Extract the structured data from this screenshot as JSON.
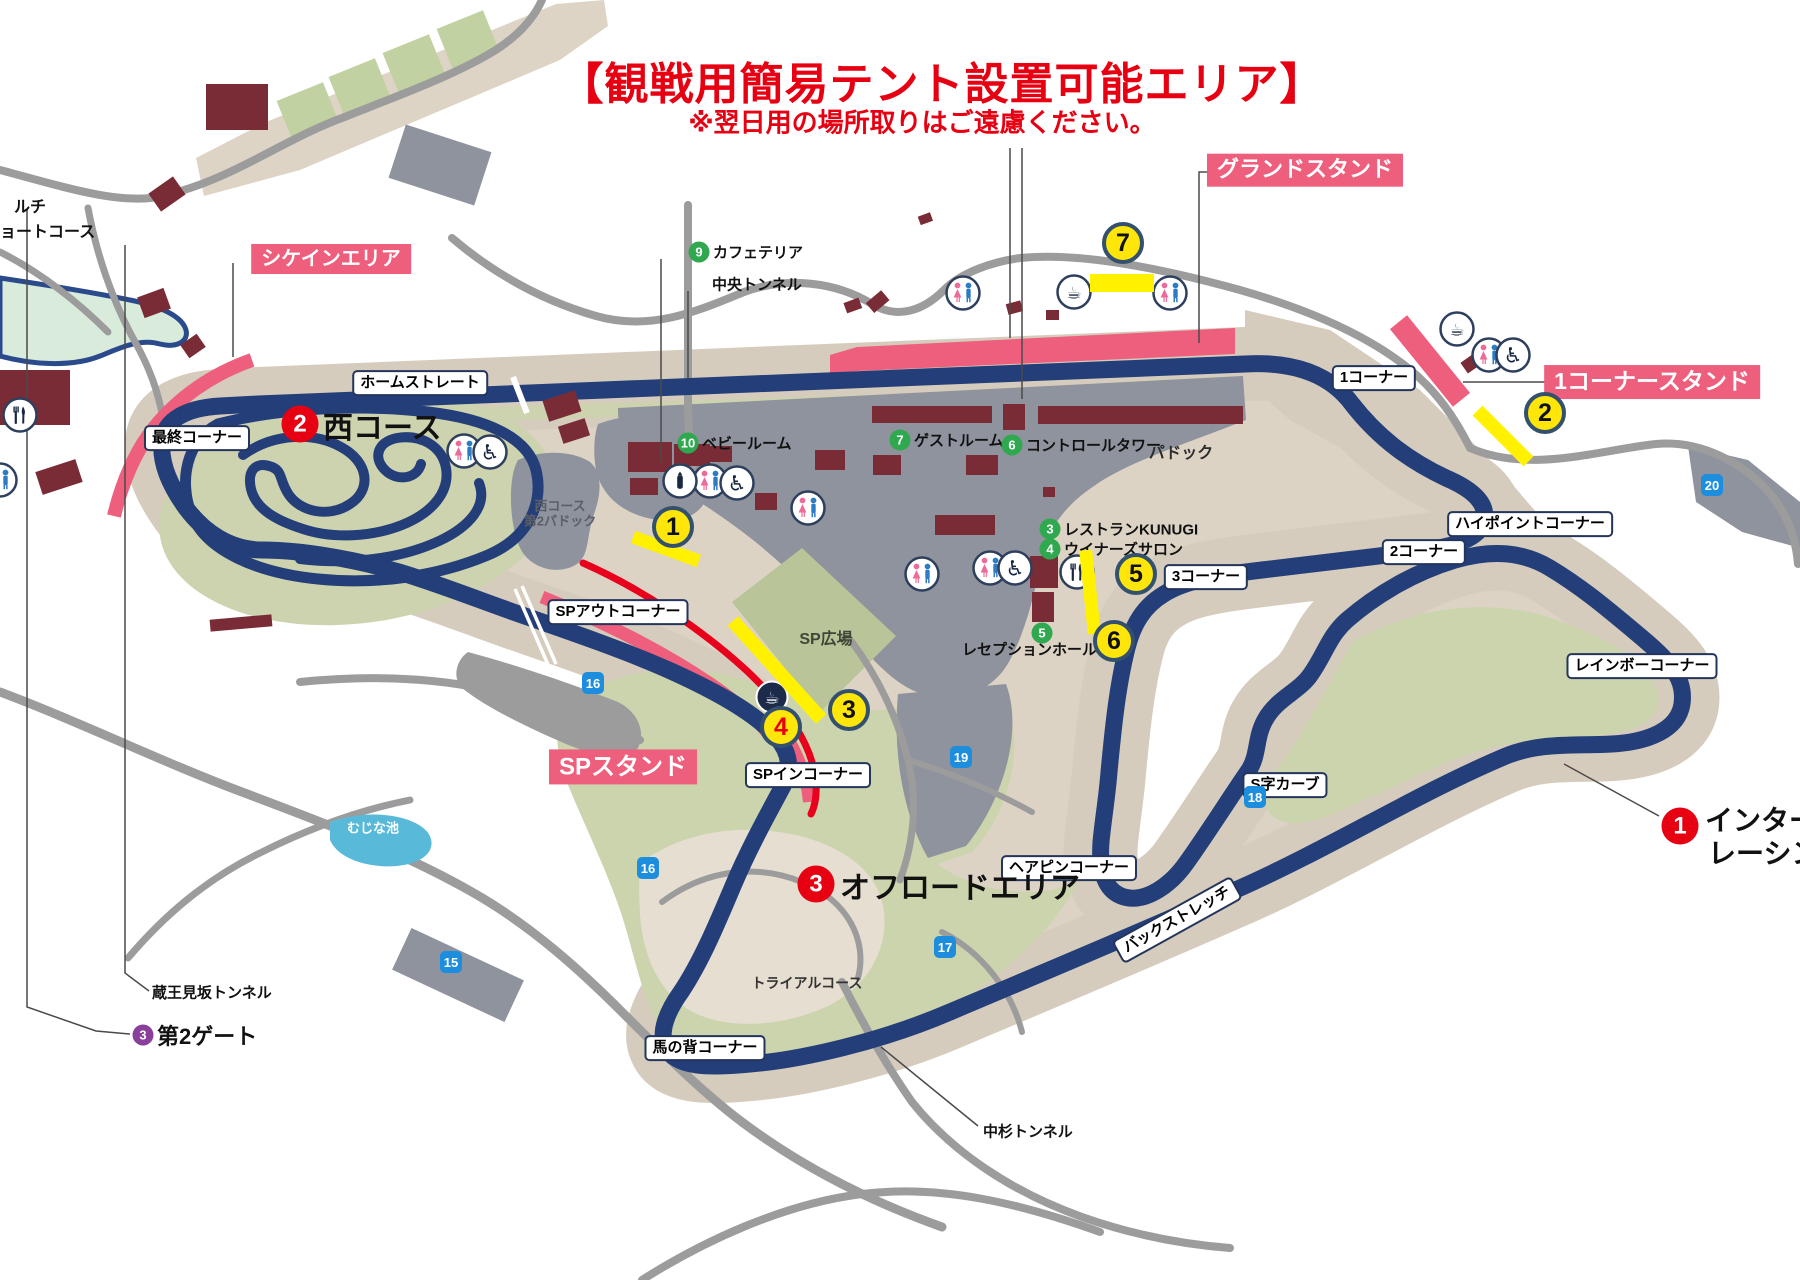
{
  "title": {
    "main": "【観戦用簡易テント設置可能エリア】",
    "note": "※翌日用の場所取りはご遠慮ください。",
    "color": "#e60012"
  },
  "colors": {
    "track_navy": "#233e78",
    "stand_pink": "#ee5f7d",
    "highlight_yellow": "#fff100",
    "highlight_red": "#e8001c",
    "facility_green": "#2fa84f",
    "gate_purple": "#8a3f9b",
    "badge_blue": "#1d8ede",
    "title_red": "#e60012"
  },
  "pink_labels": [
    {
      "t": "シケインエリア",
      "x": 331,
      "y": 259,
      "fs": 20
    },
    {
      "t": "グランドスタンド",
      "x": 1305,
      "y": 170,
      "fs": 22
    },
    {
      "t": "1コーナースタンド",
      "x": 1652,
      "y": 382,
      "fs": 23
    },
    {
      "t": "SPスタンド",
      "x": 623,
      "y": 767,
      "fs": 24
    }
  ],
  "corner_labels": [
    {
      "t": "ホームストレート",
      "x": 420,
      "y": 383
    },
    {
      "t": "最終コーナー",
      "x": 197,
      "y": 438
    },
    {
      "t": "SPアウトコーナー",
      "x": 618,
      "y": 612
    },
    {
      "t": "SPインコーナー",
      "x": 808,
      "y": 775
    },
    {
      "t": "1コーナー",
      "x": 1374,
      "y": 378
    },
    {
      "t": "2コーナー",
      "x": 1424,
      "y": 552
    },
    {
      "t": "3コーナー",
      "x": 1206,
      "y": 577
    },
    {
      "t": "ハイポイントコーナー",
      "x": 1530,
      "y": 524
    },
    {
      "t": "レインボーコーナー",
      "x": 1642,
      "y": 666
    },
    {
      "t": "S字カーブ",
      "x": 1285,
      "y": 785
    },
    {
      "t": "ヘアピンコーナー",
      "x": 1069,
      "y": 868
    },
    {
      "t": "バックストレッチ",
      "x": 1177,
      "y": 920,
      "rot": -29
    },
    {
      "t": "馬の背コーナー",
      "x": 705,
      "y": 1048
    }
  ],
  "text_labels": [
    {
      "t": "中央トンネル",
      "x": 712,
      "y": 284,
      "fs": 15,
      "anchor": "left",
      "color": "#111"
    },
    {
      "t": "蔵王見坂トンネル",
      "x": 152,
      "y": 992,
      "fs": 15,
      "anchor": "left",
      "color": "#111"
    },
    {
      "t": "中杉トンネル",
      "x": 983,
      "y": 1131,
      "fs": 15,
      "anchor": "left",
      "color": "#111"
    },
    {
      "t": "パドック",
      "x": 1181,
      "y": 451,
      "fs": 16,
      "anchor": "center",
      "color": "#2d2d2d"
    },
    {
      "t": "SP広場",
      "x": 826,
      "y": 637,
      "fs": 16,
      "anchor": "center",
      "color": "#3e4637"
    },
    {
      "t": "西コース",
      "x": 560,
      "y": 505,
      "fs": 13,
      "anchor": "center",
      "color": "#5a5f66"
    },
    {
      "t": "第2パドック",
      "x": 560,
      "y": 520,
      "fs": 13,
      "anchor": "center",
      "color": "#5a5f66"
    },
    {
      "t": "トライアルコース",
      "x": 807,
      "y": 983,
      "fs": 14,
      "anchor": "center",
      "color": "#333333"
    },
    {
      "t": "むじな池",
      "x": 373,
      "y": 827,
      "fs": 13,
      "anchor": "center",
      "color": "#ffffff"
    },
    {
      "t": "ルチ",
      "x": 14,
      "y": 205,
      "fs": 16,
      "anchor": "left",
      "color": "#111"
    },
    {
      "t": "ョートコース",
      "x": 0,
      "y": 230,
      "fs": 16,
      "anchor": "left",
      "color": "#111"
    }
  ],
  "area_titles": [
    {
      "num": "2",
      "x": 300,
      "y": 424,
      "lines": [
        {
          "t": "西コース",
          "dx": 23,
          "dy": 1,
          "fs": 30
        }
      ]
    },
    {
      "num": "3",
      "x": 816,
      "y": 884,
      "lines": [
        {
          "t": "オフロードエリア",
          "dx": 24,
          "dy": 1,
          "fs": 30
        }
      ]
    },
    {
      "num": "1",
      "x": 1680,
      "y": 826,
      "lines": [
        {
          "t": "インター",
          "dx": 25,
          "dy": -7,
          "fs": 28
        },
        {
          "t": "レーシン",
          "dx": 28,
          "dy": 26,
          "fs": 28
        }
      ]
    }
  ],
  "facilities": [
    {
      "num": "9",
      "t": "カフェテリア",
      "x": 699,
      "y": 252,
      "color": "green",
      "fs": 15,
      "ldx": 14,
      "ldy": 0
    },
    {
      "num": "10",
      "t": "ベビールーム",
      "x": 688,
      "y": 443,
      "color": "green",
      "fs": 15,
      "ldx": 14,
      "ldy": 0
    },
    {
      "num": "7",
      "t": "ゲストルーム",
      "x": 900,
      "y": 440,
      "color": "green",
      "fs": 15,
      "ldx": 14,
      "ldy": 0
    },
    {
      "num": "6",
      "t": "コントロールタワー",
      "x": 1012,
      "y": 445,
      "color": "green",
      "fs": 15,
      "ldx": 14,
      "ldy": 0
    },
    {
      "num": "3",
      "t": "レストランKUNUGI",
      "x": 1050,
      "y": 529,
      "color": "green",
      "fs": 15,
      "ldx": 14,
      "ldy": 0
    },
    {
      "num": "4",
      "t": "ウイナーズサロン",
      "x": 1050,
      "y": 549,
      "color": "green",
      "fs": 15,
      "ldx": 14,
      "ldy": 0
    },
    {
      "num": "5",
      "t": "レセプションホール",
      "x": 1042,
      "y": 633,
      "color": "green",
      "fs": 15,
      "ldx": -80,
      "ldy": 16
    },
    {
      "num": "3",
      "t": "第2ゲート",
      "x": 143,
      "y": 1035,
      "color": "purple",
      "fs": 22,
      "ldx": 14,
      "ldy": 0
    }
  ],
  "tent_markers": [
    {
      "n": "1",
      "x": 673,
      "y": 527
    },
    {
      "n": "2",
      "x": 1545,
      "y": 413
    },
    {
      "n": "3",
      "x": 849,
      "y": 710
    },
    {
      "n": "4",
      "x": 781,
      "y": 727,
      "red": true
    },
    {
      "n": "5",
      "x": 1136,
      "y": 574
    },
    {
      "n": "6",
      "x": 1114,
      "y": 641
    },
    {
      "n": "7",
      "x": 1123,
      "y": 243
    }
  ],
  "tent_strips": [
    {
      "x": 666,
      "y": 549,
      "w": 70,
      "h": 13,
      "r": 20
    },
    {
      "x": 1503,
      "y": 436,
      "w": 72,
      "h": 14,
      "r": 45
    },
    {
      "x": 777,
      "y": 670,
      "w": 132,
      "h": 14,
      "r": 48
    },
    {
      "x": 1090,
      "y": 592,
      "w": 84,
      "h": 13,
      "r": 84
    },
    {
      "x": 1122,
      "y": 283,
      "w": 64,
      "h": 18,
      "r": 0
    }
  ],
  "route_badges": [
    {
      "n": "15",
      "x": 451,
      "y": 962
    },
    {
      "n": "16",
      "x": 593,
      "y": 683
    },
    {
      "n": "16",
      "x": 648,
      "y": 868
    },
    {
      "n": "17",
      "x": 945,
      "y": 947
    },
    {
      "n": "18",
      "x": 1255,
      "y": 797
    },
    {
      "n": "19",
      "x": 961,
      "y": 757
    },
    {
      "n": "20",
      "x": 1712,
      "y": 485
    }
  ],
  "icons": [
    {
      "type": "toilet",
      "x": 464,
      "y": 451
    },
    {
      "type": "toilet",
      "x": 710,
      "y": 481
    },
    {
      "type": "toilet",
      "x": 808,
      "y": 508
    },
    {
      "type": "toilet",
      "x": 922,
      "y": 574
    },
    {
      "type": "toilet",
      "x": 990,
      "y": 568
    },
    {
      "type": "toilet",
      "x": 963,
      "y": 293
    },
    {
      "type": "toilet",
      "x": 1170,
      "y": 293
    },
    {
      "type": "toilet",
      "x": 1489,
      "y": 355
    },
    {
      "type": "toilet",
      "x": 0,
      "y": 480
    },
    {
      "type": "wheelchair",
      "x": 490,
      "y": 452
    },
    {
      "type": "wheelchair",
      "x": 737,
      "y": 483
    },
    {
      "type": "wheelchair",
      "x": 1015,
      "y": 568
    },
    {
      "type": "wheelchair",
      "x": 1513,
      "y": 355
    },
    {
      "type": "coffee",
      "x": 1074,
      "y": 292
    },
    {
      "type": "coffee",
      "x": 1457,
      "y": 329
    },
    {
      "type": "coffee-dark",
      "x": 772,
      "y": 697
    },
    {
      "type": "restaurant",
      "x": 1077,
      "y": 572
    },
    {
      "type": "restaurant",
      "x": 20,
      "y": 415
    },
    {
      "type": "bottle",
      "x": 680,
      "y": 481
    }
  ]
}
